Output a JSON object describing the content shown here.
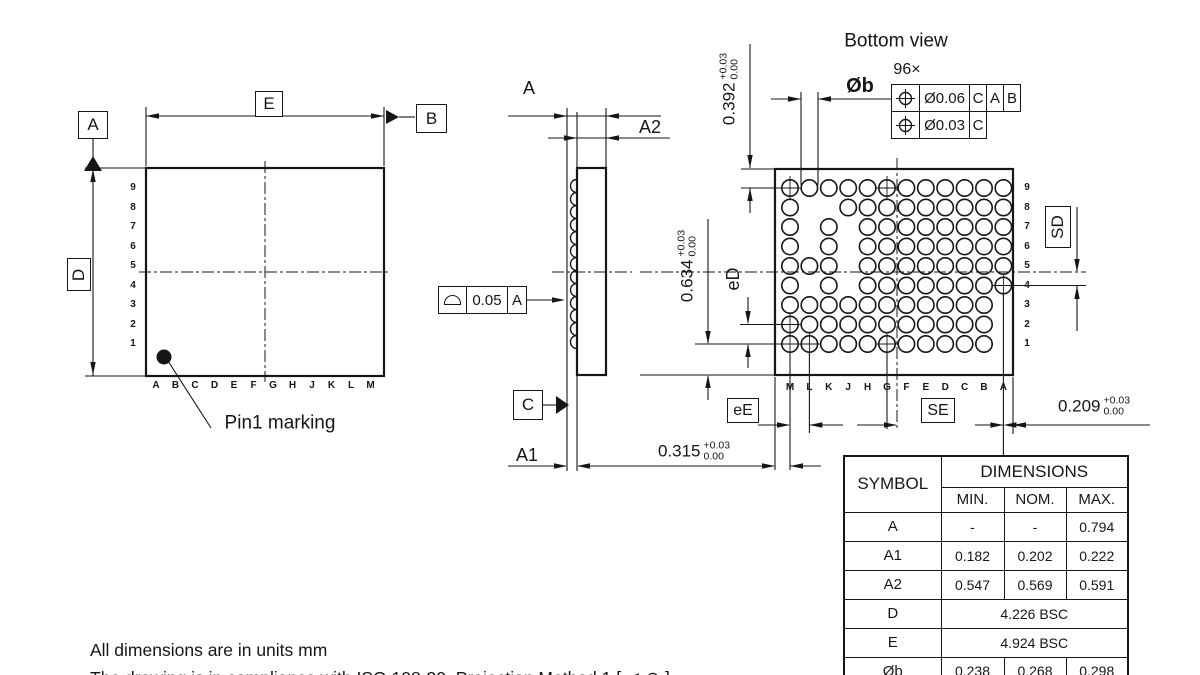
{
  "notes": {
    "line1": "All dimensions are in units mm",
    "line2": "The drawing is in compliance with ISO 128-30. Projection Method 1 [ ⊲ ⊕ ]"
  },
  "top_view": {
    "datum_a": "A",
    "datum_b": "B",
    "dim_e": "E",
    "dim_d": "D",
    "pin1_label": "Pin1 marking",
    "row_labels": [
      "9",
      "8",
      "7",
      "6",
      "5",
      "4",
      "3",
      "2",
      "1"
    ],
    "col_labels": [
      "A",
      "B",
      "C",
      "D",
      "E",
      "F",
      "G",
      "H",
      "J",
      "K",
      "L",
      "M"
    ]
  },
  "side_view": {
    "dim_a": "A",
    "dim_a2": "A2",
    "dim_a1": "A1",
    "datum_c": "C",
    "fcf": {
      "symbol": "profile-of-a-surface",
      "tolerance": "0.05",
      "datum": "A"
    }
  },
  "bottom_view": {
    "title": "Bottom view",
    "ball_count": "96×",
    "ball_dia_label": "Øb",
    "fcf1": {
      "symbol": "position",
      "value": "Ø0.06",
      "datums": [
        "C",
        "A",
        "B"
      ]
    },
    "fcf2": {
      "symbol": "position",
      "value": "Ø0.03",
      "datums": [
        "C"
      ]
    },
    "dim_edge_to_row9": {
      "value": "0.392",
      "tol_plus": "+0.03",
      "tol_minus": "0.00"
    },
    "dim_row1_to_edge": {
      "value": "0.634",
      "tol_plus": "+0.03",
      "tol_minus": "0.00"
    },
    "dim_edge_to_colm": {
      "value": "0.315",
      "tol_plus": "+0.03",
      "tol_minus": "0.00"
    },
    "dim_cola_to_edge": {
      "value": "0.209",
      "tol_plus": "+0.03",
      "tol_minus": "0.00"
    },
    "pitch_d_label": "eD",
    "pitch_e_label": "eE",
    "sd_label": "SD",
    "se_label": "SE",
    "row_labels": [
      "9",
      "8",
      "7",
      "6",
      "5",
      "4",
      "3",
      "2",
      "1"
    ],
    "col_labels": [
      "M",
      "L",
      "K",
      "J",
      "H",
      "G",
      "F",
      "E",
      "D",
      "C",
      "B",
      "A"
    ],
    "ball_rows": [
      {
        "row": "9",
        "cols": "MLKJHGFEDCBA"
      },
      {
        "row": "8",
        "cols": "MJHGFEDCBA"
      },
      {
        "row": "7",
        "cols": "MKHGFEDCBA"
      },
      {
        "row": "6",
        "cols": "MKHGFEDCBA"
      },
      {
        "row": "5",
        "cols": "MLKHGFEDCBA"
      },
      {
        "row": "4",
        "cols": "MKHGFEDCBA"
      },
      {
        "row": "3",
        "cols": "MLKJHGFEDCB"
      },
      {
        "row": "2",
        "cols": "MLKJHGFEDCB"
      },
      {
        "row": "1",
        "cols": "MLKJHGFEDCB"
      }
    ],
    "crosshair_balls": [
      "M9",
      "G9",
      "A4",
      "M2",
      "M1",
      "L1",
      "G1"
    ]
  },
  "table": {
    "symbol_header": "SYMBOL",
    "dimensions_header": "DIMENSIONS",
    "col_headers": [
      "MIN.",
      "NOM.",
      "MAX."
    ],
    "rows": [
      {
        "symbol": "A",
        "min": "-",
        "nom": "-",
        "max": "0.794"
      },
      {
        "symbol": "A1",
        "min": "0.182",
        "nom": "0.202",
        "max": "0.222"
      },
      {
        "symbol": "A2",
        "min": "0.547",
        "nom": "0.569",
        "max": "0.591"
      },
      {
        "symbol": "D",
        "span": "4.226 BSC"
      },
      {
        "symbol": "E",
        "span": "4.924 BSC"
      },
      {
        "symbol": "Øb",
        "min": "0.238",
        "nom": "0.268",
        "max": "0.298"
      }
    ]
  }
}
